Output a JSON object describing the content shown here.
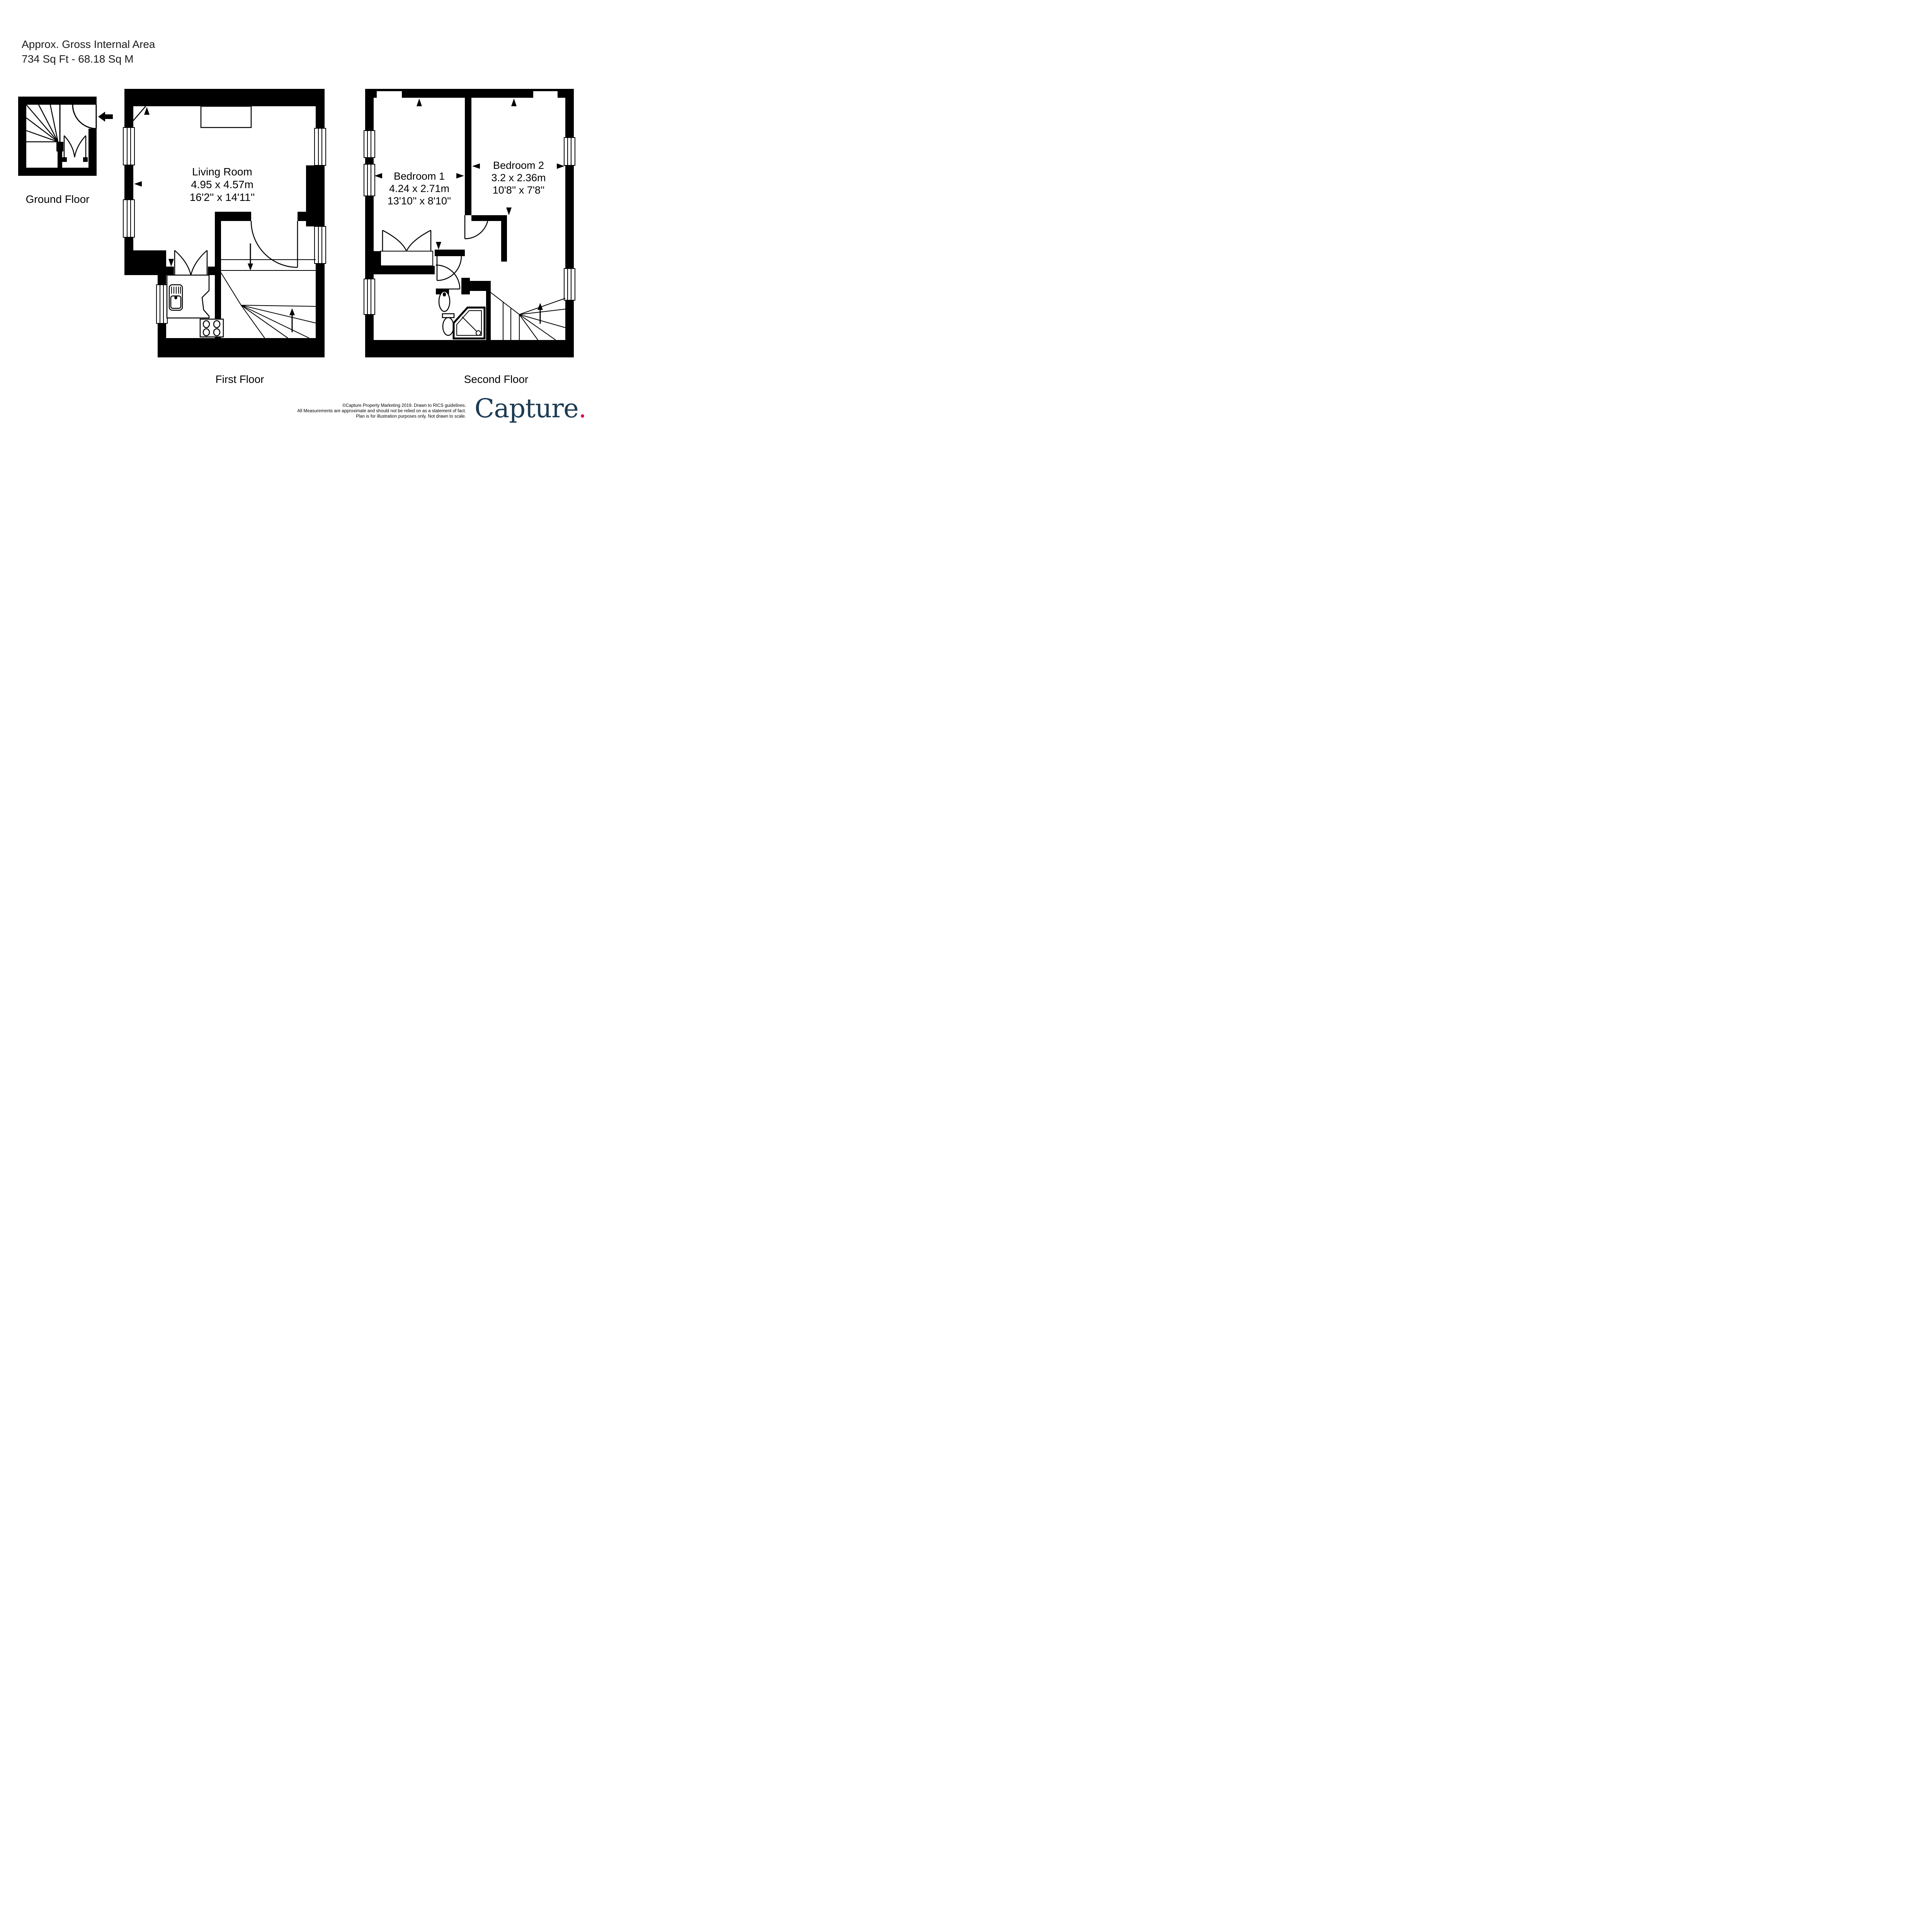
{
  "header": {
    "line1": "Approx. Gross Internal Area",
    "line2": "734 Sq Ft  -  68.18 Sq M"
  },
  "floors": {
    "ground": {
      "label": "Ground Floor"
    },
    "first": {
      "label": "First Floor",
      "rooms": {
        "living_room": {
          "name": "Living Room",
          "metric": "4.95 x 4.57m",
          "imperial": "16'2'' x 14'11''"
        }
      }
    },
    "second": {
      "label": "Second Floor",
      "rooms": {
        "bedroom1": {
          "name": "Bedroom 1",
          "metric": "4.24 x 2.71m",
          "imperial": "13'10'' x 8'10''"
        },
        "bedroom2": {
          "name": "Bedroom 2",
          "metric": "3.2 x 2.36m",
          "imperial": "10'8'' x 7'8''"
        }
      }
    }
  },
  "footer": {
    "line1": "©Capture Property Marketing 2019. Drawn to RICS guidelines.",
    "line2": "All Measurements are approximate and should not be relied on as a statement of fact.",
    "line3": "Plan is for illustration purposes only. Not drawn to scale."
  },
  "logo": {
    "text": "Capture",
    "dot": ".",
    "color": "#1D3B53",
    "dot_color": "#DB0A5B"
  },
  "colors": {
    "walls": "#000000",
    "background": "#FFFFFF"
  }
}
